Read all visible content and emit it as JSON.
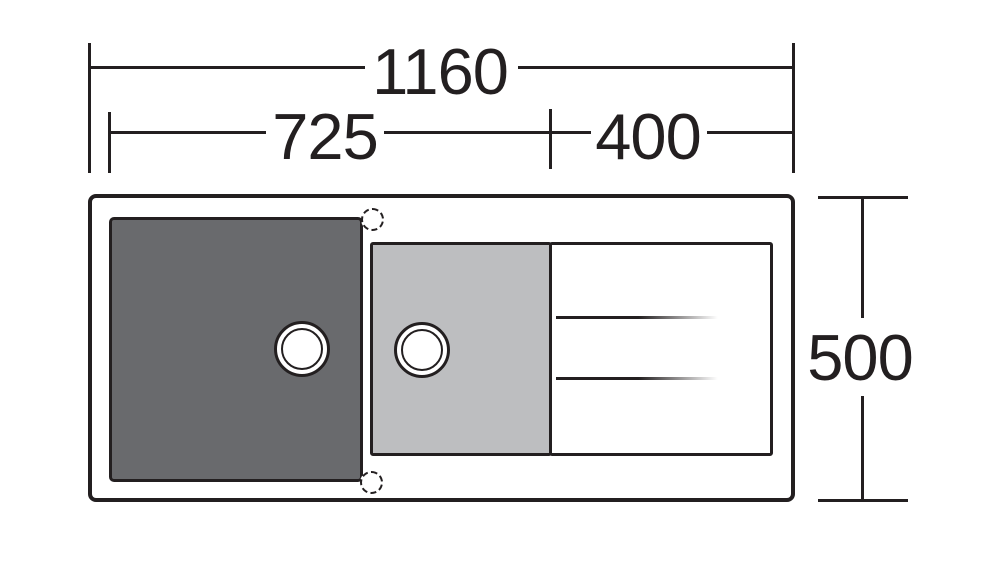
{
  "drawing": {
    "dimensions": {
      "overall_width": "1160",
      "bowl_section_width": "725",
      "drainer_width": "400",
      "overall_depth": "500"
    }
  },
  "icons": {
    "drain_hole": "css-double-ring-circle",
    "tap_hole": "css-dashed-circle"
  },
  "colors": {
    "line": "#231f20",
    "bowl_dark": "#696a6d",
    "bowl_light": "#bdbec0",
    "background": "#ffffff"
  }
}
